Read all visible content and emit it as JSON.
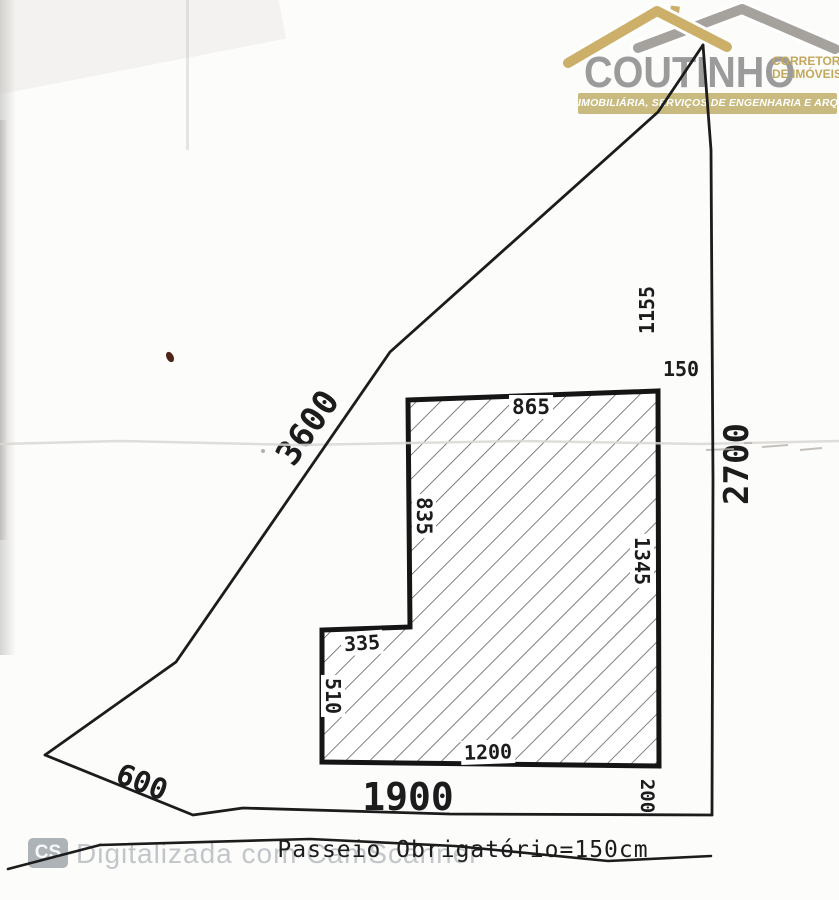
{
  "logo": {
    "brand": "COUTINHO",
    "subtitle_line1": "CORRETOR",
    "subtitle_line2": "DE IMÓVEIS",
    "banner": "IMOBILIÁRIA, SERVIÇOS DE ENGENHARIA E ARQUITETURA",
    "colors": {
      "roof_gold": "#ccb06a",
      "roof_gray": "#a5a19c",
      "brand_text": "#9b9b9b",
      "subtitle_gold": "#c3a75c",
      "banner_bg": "#c9ba80"
    }
  },
  "drawing": {
    "ink_color": "#1c1c1c",
    "lot_dimensions": {
      "left_side": "3600",
      "right_side": "2700",
      "bottom_left_side": "600",
      "frontage": "1900"
    },
    "building_dimensions": {
      "top_width": "865",
      "upper_left_depth": "835",
      "right_depth": "1345",
      "step_width": "335",
      "lower_left_depth": "510",
      "bottom_width": "1200",
      "rear_right_offset": "200",
      "front_right_offset": "150",
      "right_side_offset": "1155"
    },
    "sidewalk_note": "Passeio Obrigatório=150cm"
  },
  "watermark": {
    "badge": "CS",
    "label": "Digitalizada com CamScanner"
  }
}
